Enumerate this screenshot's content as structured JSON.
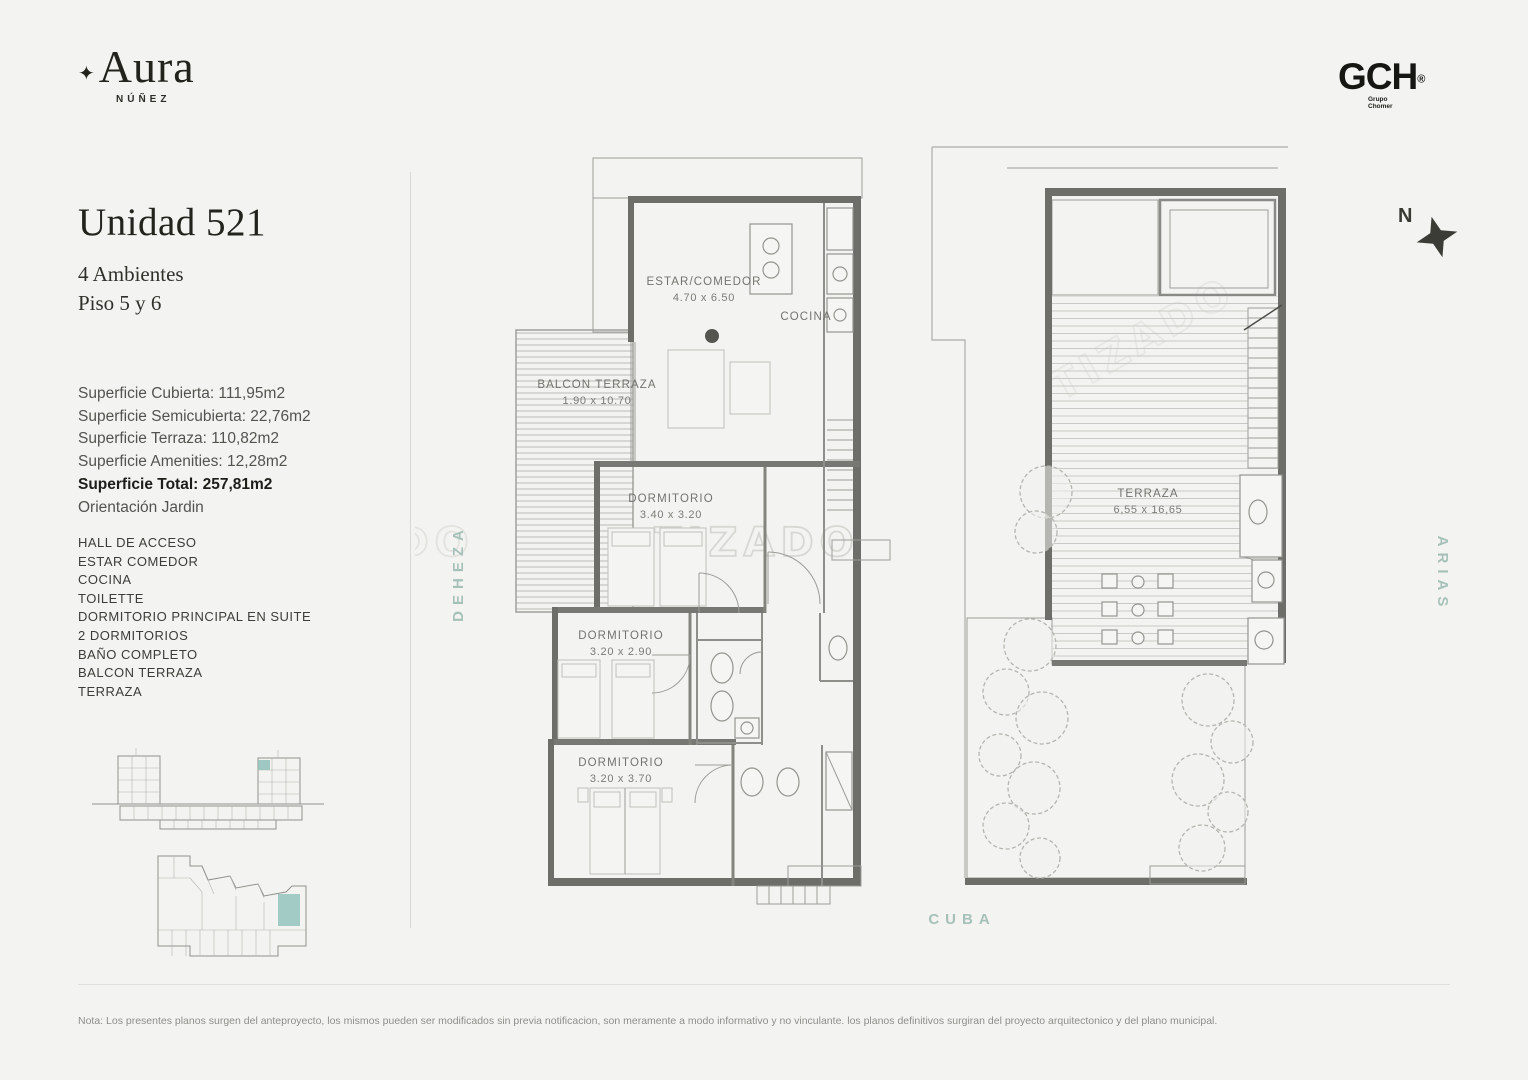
{
  "brand": {
    "mark": "✦",
    "name": "Aura",
    "sub": "NÚÑEZ"
  },
  "developer": {
    "name": "GCH",
    "reg": "®",
    "line1": "Grupo",
    "line2": "Chomer"
  },
  "unit": {
    "title": "Unidad 521",
    "rooms_count": "4 Ambientes",
    "floors": "Piso 5 y 6",
    "surfaces": [
      "Superficie Cubierta: 111,95m2",
      "Superficie Semicubierta: 22,76m2",
      "Superficie Terraza: 110,82m2",
      "Superficie Amenities: 12,28m2"
    ],
    "surface_total": "Superficie Total: 257,81m2",
    "orientation": "Orientación Jardin",
    "features": [
      "HALL DE ACCESO",
      "ESTAR COMEDOR",
      "COCINA",
      "TOILETTE",
      "DORMITORIO PRINCIPAL EN SUITE",
      "2 DORMITORIOS",
      "BAÑO COMPLETO",
      "BALCON TERRAZA",
      "TERRAZA"
    ]
  },
  "plan_floor5": {
    "estar_comedor": {
      "name": "ESTAR/COMEDOR",
      "dims": "4.70 x 6.50"
    },
    "cocina": {
      "name": "COCINA"
    },
    "balcon": {
      "name": "BALCON TERRAZA",
      "dims": "1.90 x 10.70"
    },
    "dormitorio_1": {
      "name": "DORMITORIO",
      "dims": "3.40 x 3.20"
    },
    "dormitorio_2": {
      "name": "DORMITORIO",
      "dims": "3.20 x 2.90"
    },
    "dormitorio_3": {
      "name": "DORMITORIO",
      "dims": "3.20 x 3.70"
    }
  },
  "plan_floor6": {
    "terraza": {
      "name": "TERRAZA",
      "dims": "6,55 x 16,65"
    }
  },
  "streets": {
    "left": "DEHEZA",
    "right": "ARIAS",
    "bottom": "CUBA"
  },
  "compass": {
    "label": "N"
  },
  "watermark": {
    "text": "TIZADO"
  },
  "footer": {
    "note": "Nota: Los presentes planos surgen del anteproyecto, los mismos pueden ser modificados sin previa notificacion, son meramente a modo informativo y no vinculante. los planos definitivos surgiran del proyecto arquitectonico y del plano municipal."
  },
  "colors": {
    "background": "#f3f3f1",
    "street_label": "#a6c1ba",
    "unit_highlight": "#8fc0ba",
    "plan_line": "#8f8f8b",
    "text_dark": "#23231e"
  }
}
